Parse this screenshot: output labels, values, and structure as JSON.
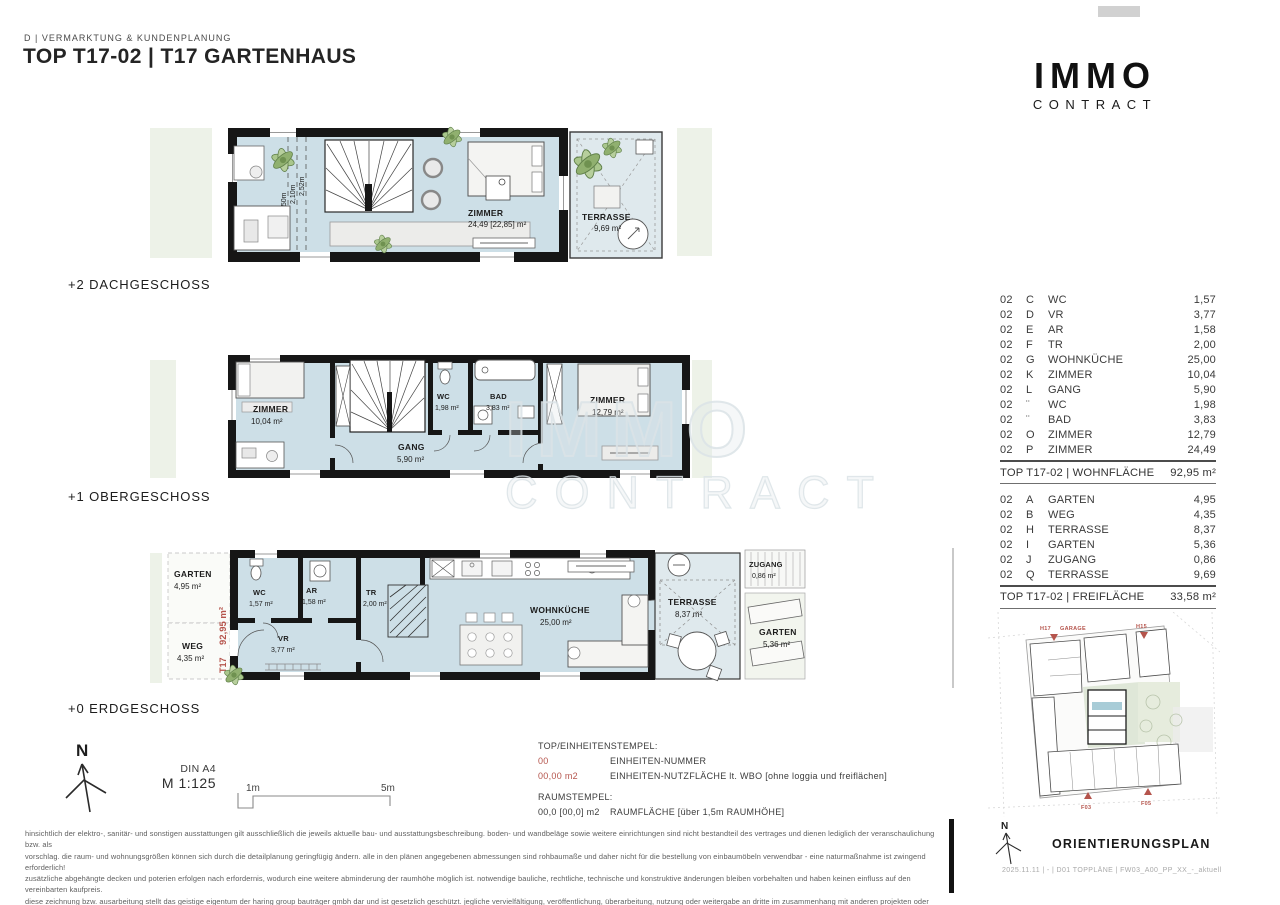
{
  "header": {
    "department": "D | VERMARKTUNG & KUNDENPLANUNG",
    "title": "TOP T17-02 | T17 GARTENHAUS"
  },
  "logo": {
    "line1": "IMMO",
    "line2": "CONTRACT"
  },
  "watermark": {
    "line1": "IMMO",
    "line2": "CONTRACT"
  },
  "compass": {
    "n": "N"
  },
  "colors": {
    "floor_blue": "#cddfe7",
    "terrace_blue": "#dfe9ed",
    "site_green": "#edf2e8",
    "accent_red": "#b5544c",
    "wall_black": "#161616"
  },
  "floors": [
    {
      "label": "+2 DACHGESCHOSS",
      "rooms": [
        {
          "name": "ZIMMER",
          "area": "24,49 [22,85] m²"
        },
        {
          "name": "TERRASSE",
          "area": "9,69 m²"
        }
      ],
      "heights": [
        "1,50m",
        "2,10m",
        "2,52m"
      ]
    },
    {
      "label": "+1 OBERGESCHOSS",
      "rooms": [
        {
          "name": "ZIMMER",
          "area": "10,04 m²"
        },
        {
          "name": "WC",
          "area": "1,98 m²"
        },
        {
          "name": "BAD",
          "area": "3,83 m²"
        },
        {
          "name": "ZIMMER",
          "area": "12,79 m²"
        },
        {
          "name": "GANG",
          "area": "5,90 m²"
        }
      ]
    },
    {
      "label": "+0 ERDGESCHOSS",
      "rooms": [
        {
          "name": "GARTEN",
          "area": "4,95 m²"
        },
        {
          "name": "WEG",
          "area": "4,35 m²"
        },
        {
          "name": "WC",
          "area": "1,57 m²"
        },
        {
          "name": "AR",
          "area": "1,58 m²"
        },
        {
          "name": "TR",
          "area": "2,00 m²"
        },
        {
          "name": "VR",
          "area": "3,77 m²"
        },
        {
          "name": "WOHNKÜCHE",
          "area": "25,00 m²"
        },
        {
          "name": "TERRASSE",
          "area": "8,37 m²"
        },
        {
          "name": "ZUGANG",
          "area": "0,86 m²"
        },
        {
          "name": "GARTEN",
          "area": "5,36 m²"
        }
      ],
      "stamps": {
        "total": "92,95 m²",
        "unit": "T17",
        "number": "02"
      }
    }
  ],
  "area_table": {
    "wohnflaeche": {
      "rows": [
        {
          "unit": "02",
          "letter": "C",
          "name": "WC",
          "value": "1,57"
        },
        {
          "unit": "02",
          "letter": "D",
          "name": "VR",
          "value": "3,77"
        },
        {
          "unit": "02",
          "letter": "E",
          "name": "AR",
          "value": "1,58"
        },
        {
          "unit": "02",
          "letter": "F",
          "name": "TR",
          "value": "2,00"
        },
        {
          "unit": "02",
          "letter": "G",
          "name": "WOHNKÜCHE",
          "value": "25,00"
        },
        {
          "unit": "02",
          "letter": "K",
          "name": "ZIMMER",
          "value": "10,04"
        },
        {
          "unit": "02",
          "letter": "L",
          "name": "GANG",
          "value": "5,90"
        },
        {
          "unit": "02",
          "letter": "¨",
          "name": "WC",
          "value": "1,98"
        },
        {
          "unit": "02",
          "letter": "¨",
          "name": "BAD",
          "value": "3,83"
        },
        {
          "unit": "02",
          "letter": "O",
          "name": "ZIMMER",
          "value": "12,79"
        },
        {
          "unit": "02",
          "letter": "P",
          "name": "ZIMMER",
          "value": "24,49"
        }
      ],
      "total_label": "TOP T17-02 | WOHNFLÄCHE",
      "total_value": "92,95 m²"
    },
    "freiflaeche": {
      "rows": [
        {
          "unit": "02",
          "letter": "A",
          "name": "GARTEN",
          "value": "4,95"
        },
        {
          "unit": "02",
          "letter": "B",
          "name": "WEG",
          "value": "4,35"
        },
        {
          "unit": "02",
          "letter": "H",
          "name": "TERRASSE",
          "value": "8,37"
        },
        {
          "unit": "02",
          "letter": "I",
          "name": "GARTEN",
          "value": "5,36"
        },
        {
          "unit": "02",
          "letter": "J",
          "name": "ZUGANG",
          "value": "0,86"
        },
        {
          "unit": "02",
          "letter": "Q",
          "name": "TERRASSE",
          "value": "9,69"
        }
      ],
      "total_label": "TOP T17-02 | FREIFLÄCHE",
      "total_value": "33,58 m²"
    }
  },
  "legend": {
    "stamp_title": "TOP/EINHEITENSTEMPEL:",
    "unit_number_sample": "00",
    "unit_number_desc": "EINHEITEN-NUMMER",
    "unit_area_sample": "00,00 m2",
    "unit_area_desc": "EINHEITEN-NUTZFLÄCHE lt. WBO [ohne loggia und freiflächen]",
    "room_title": "RAUMSTEMPEL:",
    "room_sample": "00,0 [00,0] m2",
    "room_desc": "RAUMFLÄCHE [über 1,5m RAUMHÖHE]"
  },
  "scale": {
    "din": "DIN A4",
    "ratio": "M 1:125",
    "tick1": "1m",
    "tick2": "5m"
  },
  "disclaimer": {
    "lines": [
      "hinsichtlich der elektro-, sanitär- und sonstigen ausstattungen gilt ausschließlich die jeweils aktuelle bau- und ausstattungsbeschreibung. boden- und wandbeläge sowie weitere einrichtungen sind nicht bestandteil des vertrages und dienen lediglich der veranschaulichung bzw. als",
      "vorschlag. die raum- und wohnungsgrößen können sich durch die detailplanung geringfügig ändern. alle in den plänen angegebenen abmessungen sind rohbaumaße und daher nicht für die bestellung von einbaumöbeln verwendbar - eine naturmaßnahme ist zwingend erforderlich!",
      "zusätzliche abgehängte decken und poterien erfolgen nach erfordernis, wodurch eine weitere abminderung der raumhöhe möglich ist. notwendige bauliche, rechtliche, technische und konstruktive änderungen bleiben vorbehalten und haben keinen einfluss auf den vereinbarten kaufpreis.",
      "diese zeichnung bzw. ausarbeitung stellt das geistige eigentum der haring group bauträger gmbh dar und ist gesetzlich geschützt. jegliche vervielfältigung, veröffentlichung, überarbeitung, nutzung oder weitergabe an dritte im zusammenhang mit anderen projekten oder arbeiten bedarf",
      "der ausdrücklichen schriftlichen zustimmung des planers. unverbindliche plankopie - druckfehler, irrtümer und änderungen vorbehalten."
    ]
  },
  "orientation": {
    "title": "ORIENTIERUNGSPLAN",
    "footer": "2025.11.11 | - | D01 TOPPLÄNE | FW03_A00_PP_XX_-_aktuell",
    "labels": [
      "H17",
      "GARAGE",
      "H15",
      "F03",
      "F05"
    ]
  }
}
